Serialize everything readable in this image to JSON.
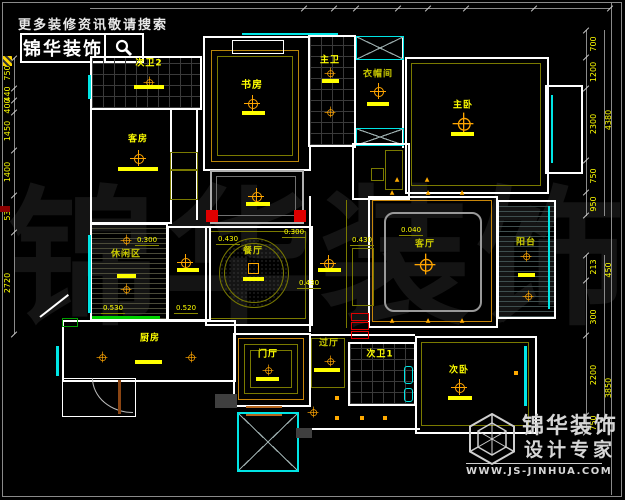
{
  "header": {
    "tagline": "更多装修资讯敬请搜索",
    "brand": "锦华装饰",
    "search_icon": "magnifier-icon"
  },
  "watermark": "锦华装饰",
  "footer": {
    "logo_icon": "hexagon-cube-icon",
    "brand": "锦华装饰",
    "subtitle": "设计专家",
    "website": "WWW.JS-JINHUA.COM"
  },
  "rooms": {
    "bath2": "次卫2",
    "guest": "客房",
    "study": "书房",
    "master_bath": "主卫",
    "closet": "衣帽间",
    "master": "主卧",
    "balcony": "阳台",
    "living": "客厅",
    "dining": "餐厅",
    "leisure": "休闲区",
    "kitchen": "厨房",
    "entry": "门厅",
    "hallway": "过厅",
    "bath1": "次卫1",
    "bedroom2": "次卧"
  },
  "elevations": {
    "dining_left": "0.430",
    "dining_top": "0.300",
    "dining_bottom": "0.430",
    "corridor": "0.430",
    "living": "0.040",
    "leisure_top": "0.300",
    "leisure_bottom": "0.530",
    "passage_bottom": "0.520"
  },
  "dimensions": {
    "left": [
      "750",
      "440",
      "400",
      "1450",
      "1400",
      "530",
      "2720"
    ],
    "right_upper": [
      "700",
      "1200",
      "2300",
      "750",
      "950"
    ],
    "right_upper_total": "4380",
    "right_lower": [
      "213",
      "300",
      "2200",
      "750"
    ],
    "right_lower_totals": [
      "450",
      "3850"
    ]
  },
  "colors": {
    "background": "#000000",
    "wall": "#ffffff",
    "label_yellow": "#ffff00",
    "compass_orange": "#ffa500",
    "window_cyan": "#00e5e5",
    "ceiling_olive": "#7a7a00",
    "accent_red": "#e00000",
    "accent_green": "#00d000"
  }
}
